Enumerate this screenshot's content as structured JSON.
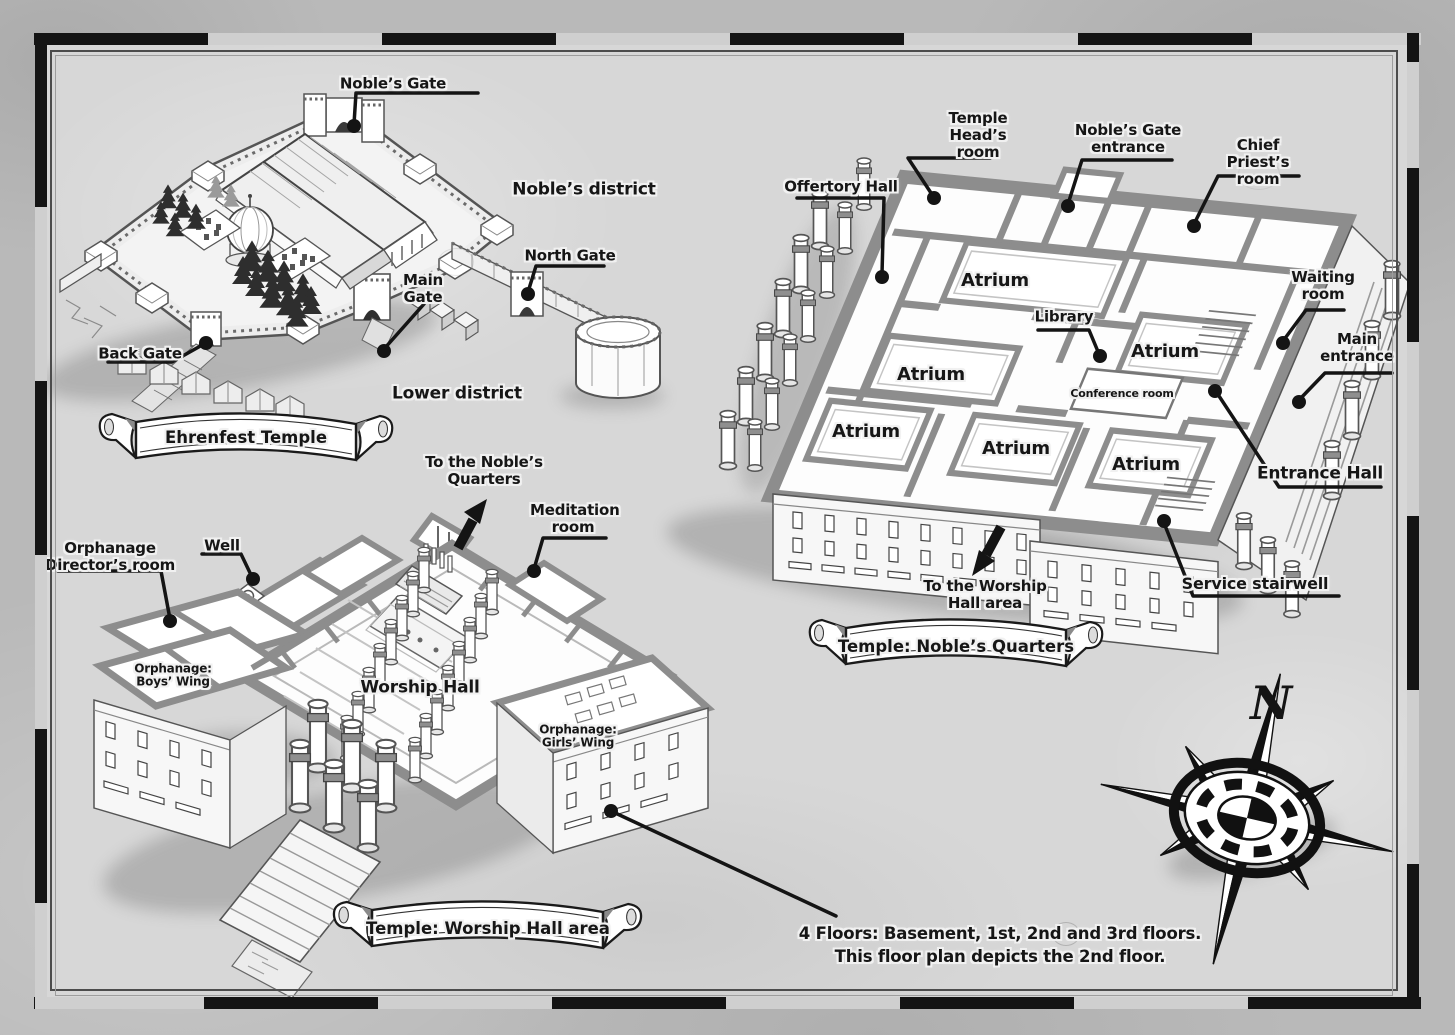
{
  "overview": {
    "banner": "Ehrenfest Temple",
    "labels": {
      "nobles_gate": "Noble’s Gate",
      "nobles_district": "Noble’s district",
      "north_gate": "North Gate",
      "main_gate": "Main Gate",
      "back_gate": "Back Gate",
      "lower_district": "Lower district"
    }
  },
  "nobles_quarters": {
    "banner": "Temple: Noble’s Quarters",
    "labels": {
      "offertory_hall": "Offertory Hall",
      "temple_heads_room": "Temple Head’s room",
      "nobles_gate_entrance": "Noble’s Gate entrance",
      "chief_priests_room": "Chief Priest’s room",
      "waiting_room": "Waiting room",
      "main_entrance": "Main entrance",
      "library": "Library",
      "conference_room": "Conference room",
      "atrium": "Atrium",
      "entrance_hall": "Entrance Hall",
      "service_stairwell": "Service stairwell",
      "to_worship_hall_area": "To the Worship Hall area"
    }
  },
  "worship_hall": {
    "banner": "Temple: Worship Hall area",
    "labels": {
      "to_nobles_quarters": "To the Noble’s Quarters",
      "meditation_room": "Meditation room",
      "orphanage_directors_room": "Orphanage Director’s room",
      "well": "Well",
      "orphanage_boys_wing": "Orphanage: Boys’ Wing",
      "worship_hall": "Worship Hall",
      "orphanage_girls_wing": "Orphanage: Girls’ Wing"
    }
  },
  "compass": {
    "north": "N"
  },
  "footnote": {
    "line1": "4 Floors: Basement, 1st, 2nd and 3rd floors.",
    "line2": "This floor plan depicts the 2nd floor."
  },
  "colors": {
    "ink": "#161616",
    "wall_gray": "#8d8d8d",
    "paper_outer": "#b9b9b9",
    "paper_inner": "#d7d7d7"
  }
}
